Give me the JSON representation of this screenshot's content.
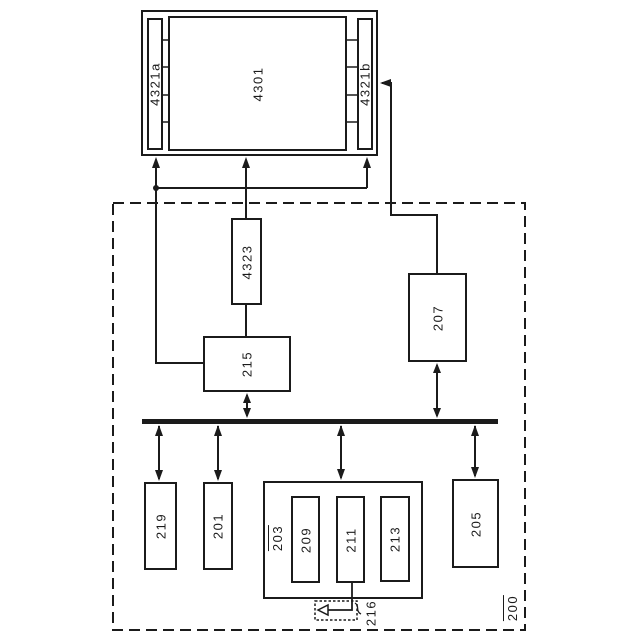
{
  "colors": {
    "ink": "#1b1b1b",
    "paper": "#ffffff"
  },
  "display_assembly": {
    "panel_label": "4301",
    "left_driver_label": "4321a",
    "right_driver_label": "4321b"
  },
  "device_box": {
    "ref_label": "200",
    "blocks": {
      "b4323": "4323",
      "b215": "215",
      "b207": "207",
      "b219": "219",
      "b201": "201",
      "b203": "203",
      "b209": "209",
      "b211": "211",
      "b213": "213",
      "b205": "205"
    },
    "antenna_ref_label": "216"
  }
}
